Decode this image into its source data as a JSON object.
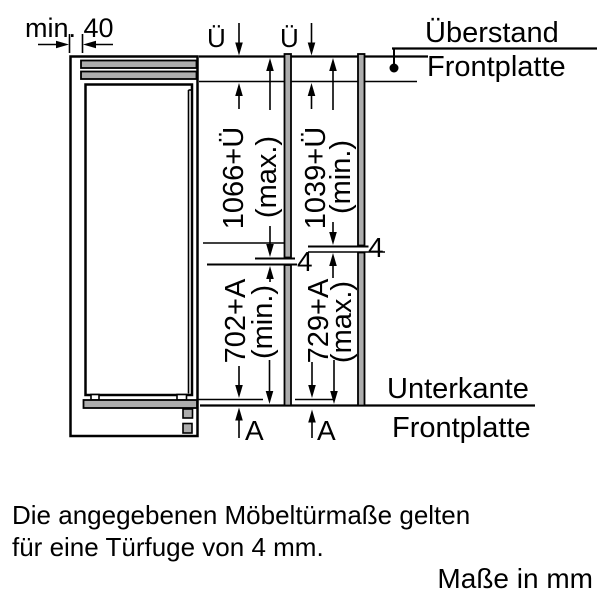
{
  "diagram": {
    "title_hint": "built-in appliance furniture door dimension drawing",
    "min_clearance_label": "min. 40",
    "u_symbol_left": "Ü",
    "u_symbol_right": "Ü",
    "overhang_callout": {
      "line1": "Überstand",
      "line2": "Frontplatte"
    },
    "upper_left_dim": {
      "value": "1066+Ü",
      "qualifier": "(max.)"
    },
    "upper_right_dim": {
      "value": "1039+Ü",
      "qualifier": "(min.)"
    },
    "lower_left_dim": {
      "value": "702+A",
      "qualifier": "(min.)"
    },
    "lower_right_dim": {
      "value": "729+A",
      "qualifier": "(max.)"
    },
    "gap_left": "4",
    "gap_right": "4",
    "a_symbol_left": "A",
    "a_symbol_right": "A",
    "bottom_edge_callout": {
      "line1": "Unterkante",
      "line2": "Frontplatte"
    }
  },
  "notes": {
    "line1": "Die angegebenen Möbeltürmaße gelten",
    "line2": "für eine Türfuge von 4 mm.",
    "units": "Maße in mm"
  },
  "colors": {
    "line": "#000000",
    "panel_fill": "#adadad",
    "background": "#ffffff"
  }
}
